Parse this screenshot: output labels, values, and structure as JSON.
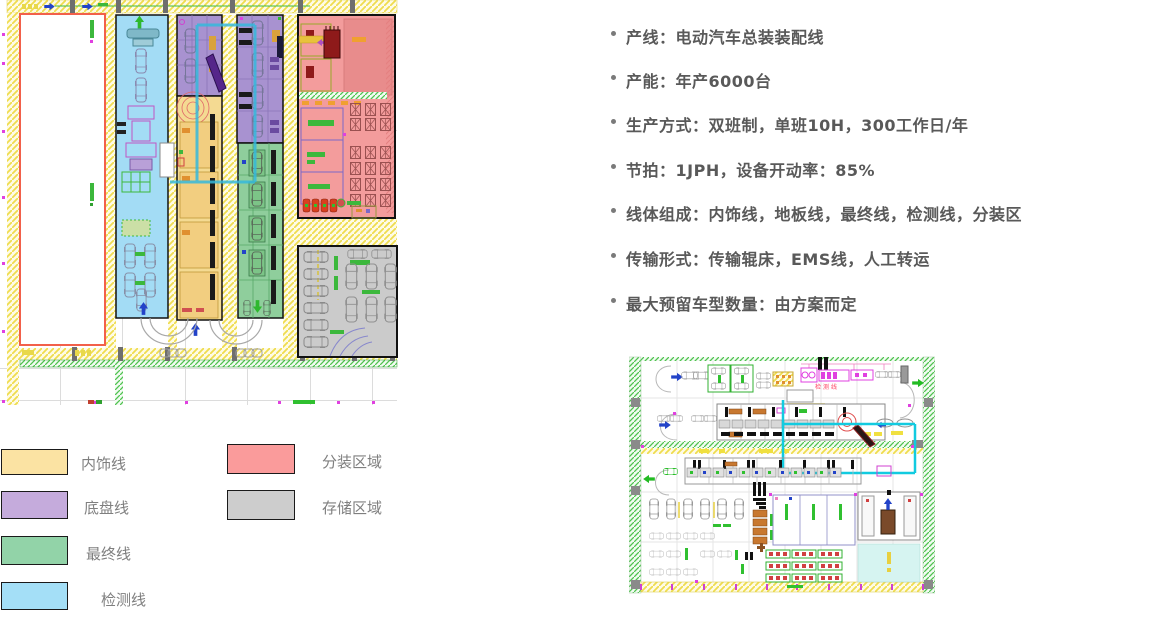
{
  "bullets": [
    "产线：电动汽车总装装配线",
    "产能：年产6000台",
    "生产方式：双班制，单班10H，300工作日/年",
    "节拍：1JPH，设备开动率：85%",
    "线体组成：内饰线，地板线，最终线，检测线，分装区",
    "传输形式：传输辊床，EMS线，人工转运",
    "最大预留车型数量：由方案而定"
  ],
  "legend": {
    "items": [
      {
        "id": "interior-line",
        "label": "内饰线",
        "color": "#FBE3A3"
      },
      {
        "id": "chassis-line",
        "label": "底盘线",
        "color": "#C5ABDC"
      },
      {
        "id": "final-line",
        "label": "最终线",
        "color": "#92D3A8"
      },
      {
        "id": "test-line",
        "label": "检测线",
        "color": "#A4DFF7"
      },
      {
        "id": "subassembly-area",
        "label": "分装区域",
        "color": "#FA9B9B"
      },
      {
        "id": "storage-area",
        "label": "存储区域",
        "color": "#CDCDCD"
      }
    ]
  },
  "main_plan": {
    "zones": {
      "test_line": "#A3DCF5",
      "interior_line": "#F4DA92",
      "chassis_line": "#A892D0",
      "final_line": "#8FCE9C",
      "subassembly": "#F39C9C",
      "storage": "#CBCBCB"
    }
  },
  "small_plan": {
    "label": "检测线",
    "ems_color": "#12CBE0"
  }
}
